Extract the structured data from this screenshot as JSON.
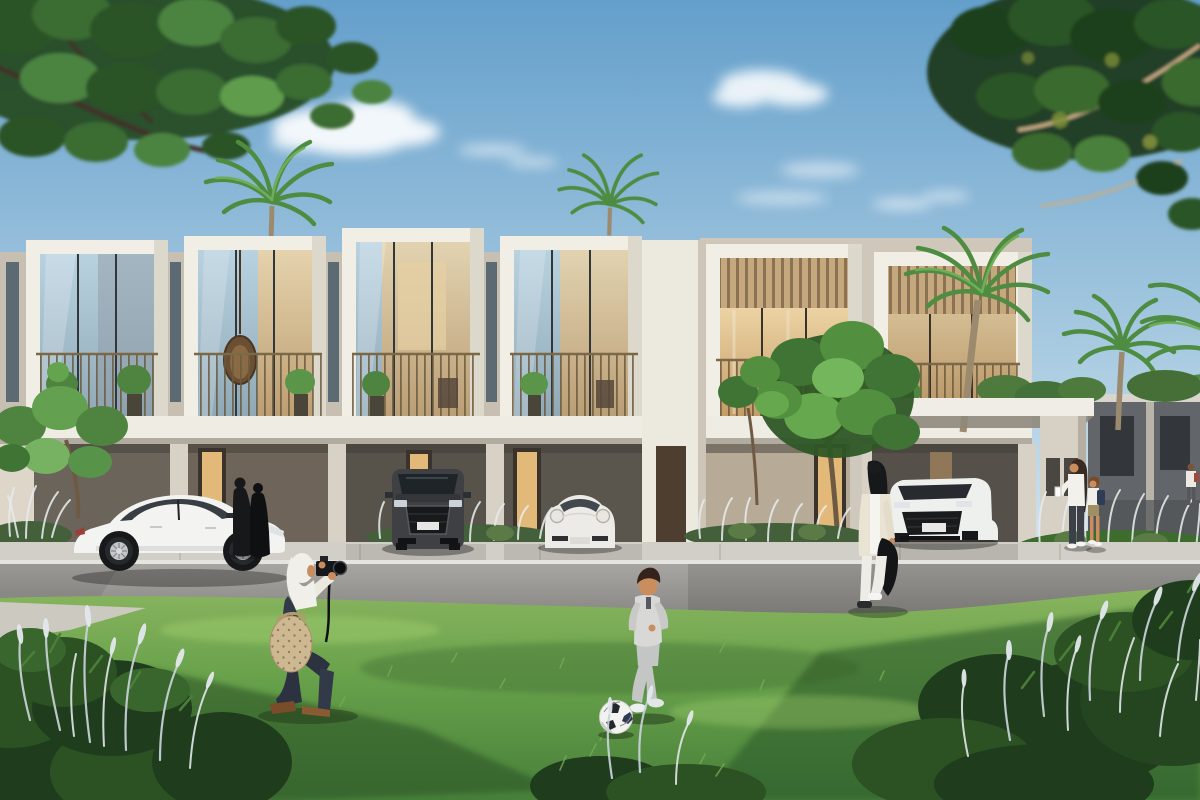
{
  "scene": {
    "type": "architectural-rendering",
    "description": "Sunny 3D render of a modern two-storey townhouse community: white concrete frames with glass balconies, timber louvre screens, palm trees, luxury cars parked at the kerb and in carports, and residents on the front lawn.",
    "sky": {
      "condition": "clear blue with soft white clouds",
      "cloud_clusters": 3
    },
    "architecture": {
      "townhouse_row": "white framed bays with full-height glazing and balcony railings",
      "right_units": "timber louvre headers over warm-lit interiors",
      "carport_canopy": "flat concrete canopy with wide pillar",
      "far_right_units": "shaded grey townhouses"
    },
    "vehicles": [
      {
        "name": "white-sedan-roadside",
        "color": "#f3f3f1"
      },
      {
        "name": "dark-grey-suv-carport",
        "color": "#3e4044"
      },
      {
        "name": "white-sports-car-carport",
        "color": "#edebe7"
      },
      {
        "name": "white-suv-under-canopy",
        "color": "#eef0ee"
      }
    ],
    "people": [
      {
        "name": "woman-kneeling-with-camera",
        "look": "white headscarf, navy outfit, patterned tote bag, camera raised"
      },
      {
        "name": "boy-kicking-football",
        "look": "light grey tracksuit, white sneakers"
      },
      {
        "name": "woman-walking-in-white",
        "look": "cream vest, white trousers, black jacket over arm"
      },
      {
        "name": "woman-with-child-by-pillar",
        "look": "white top and dark jeans; child with navy backpack"
      },
      {
        "name": "two-women-in-black-abayas",
        "look": "standing near entrance"
      },
      {
        "name": "distant-pedestrian-right-edge",
        "look": "white shirt, small backpack"
      }
    ],
    "props": [
      "football",
      "camera",
      "potted-plants",
      "hanging-egg-chair",
      "ornamental-white-grasses"
    ]
  },
  "colors": {
    "sky_top": "#649fcb",
    "sky_mid": "#a9cbe1",
    "sky_horizon": "#e2edf3",
    "cloud": "#ffffff",
    "building_white": "#f1eee6",
    "building_shade": "#ddd8cc",
    "wall_taupe": "#c6bfb2",
    "wall_taupe2": "#cfc8ba",
    "ground_recess": "#8e8779",
    "opening_dark": "#5f594e",
    "louver_tan": "#c6a87f",
    "glass_top": "#b9d2e0",
    "glass_bottom": "#8fa9b8",
    "warm_top": "#ecd3a4",
    "warm_bottom": "#c69c66",
    "door_lit": "#e2b978",
    "slab_white": "#efece4",
    "sidewalk": "#d2cfc8",
    "road_top": "#a8a6a2",
    "road_bottom": "#8a8884",
    "curb": "#e6e4df",
    "lawn_top": "#8ab55f",
    "lawn_mid": "#67a04a",
    "lawn_deep": "#47803a",
    "lawn_shadow": "#2c5526",
    "bush_dark": "#1f3d1c",
    "bush_mid": "#2c5123",
    "plume": "#c9d3d9",
    "palm_green": "#4e8c42",
    "tree_dark": "#24421f",
    "tree_mid": "#33602a",
    "tree_light": "#4f8a3f",
    "trunk": "#6e5a43",
    "abaya": "#17181a",
    "hijab": "#f1efe9",
    "navy": "#323949",
    "bag_beige": "#cdb892",
    "skin": "#c98d5e",
    "boy_top": "#d8d9d6",
    "boy_pants": "#c3c6c4",
    "walker_cream": "#e9e3d3",
    "shadow_green": "#1e3318"
  }
}
